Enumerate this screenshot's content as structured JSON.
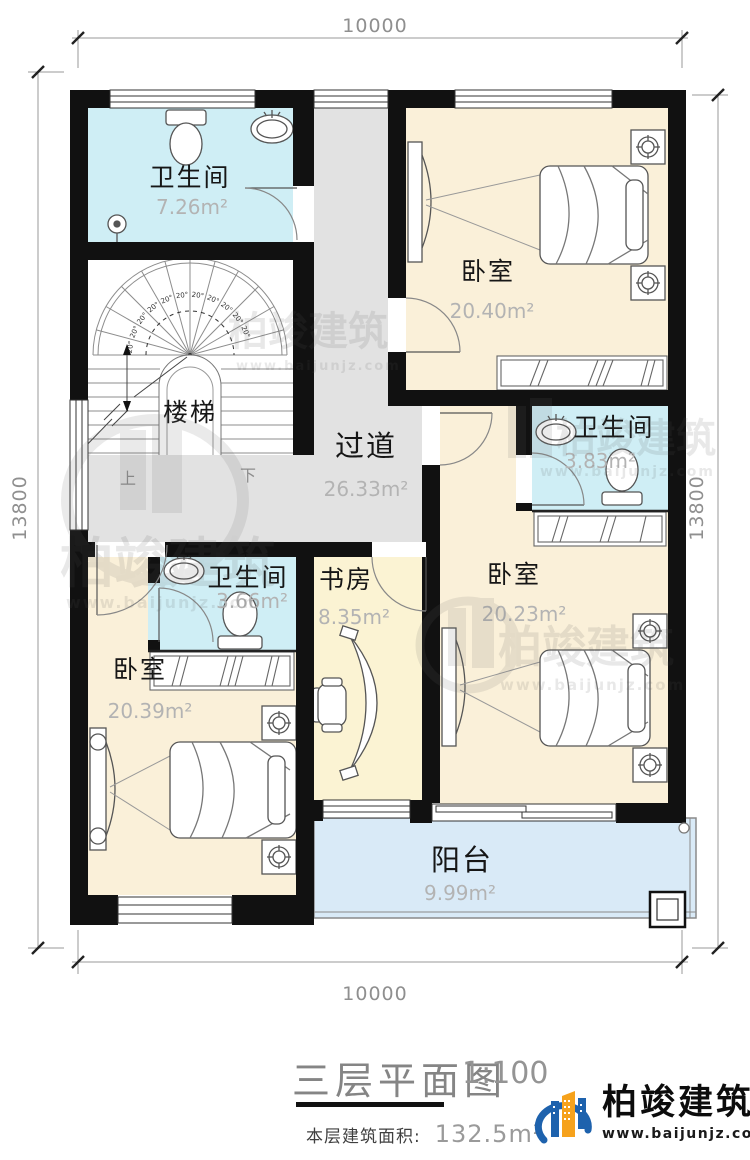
{
  "dimensions": {
    "top": "10000",
    "bottom": "10000",
    "left": "13800",
    "right": "13800"
  },
  "rooms": {
    "bath_top": {
      "label": "卫生间",
      "area": "7.26m²"
    },
    "stairs": {
      "label": "楼梯",
      "up": "上",
      "down": "下",
      "step_angle_label": "20°",
      "step_label_count": 11
    },
    "corridor": {
      "label": "过道",
      "area": "26.33m²"
    },
    "bedroom_top_right": {
      "label": "卧室",
      "area": "20.40m²"
    },
    "bath_mid_right": {
      "label": "卫生间",
      "area": "3.83m²"
    },
    "bedroom_mid_right": {
      "label": "卧室",
      "area": "20.23m²"
    },
    "study": {
      "label": "书房",
      "area": "8.35m²"
    },
    "bath_mid_left": {
      "label": "卫生间",
      "area": "3.66m²"
    },
    "bedroom_bottom_left": {
      "label": "卧室",
      "area": "20.39m²"
    },
    "balcony": {
      "label": "阳台",
      "area": "9.99m²"
    }
  },
  "title": {
    "name": "三层平面图",
    "scale": "1:100",
    "area_label": "本层建筑面积:",
    "area_value": "132.5m²"
  },
  "brand": {
    "name": "柏竣建筑",
    "url": "www.baijunjz.com"
  },
  "watermark": {
    "name": "柏竣建筑",
    "url": "www.baijunjz.com"
  },
  "colors": {
    "bath": "#cfeef5",
    "bedroom": "#faf0d9",
    "study": "#fbf3d3",
    "corridor": "#e2e2e2",
    "balcony": "#d9eaf7",
    "wall": "#111111",
    "brand_blue": "#1e62ad",
    "brand_orange": "#f6a21c"
  }
}
